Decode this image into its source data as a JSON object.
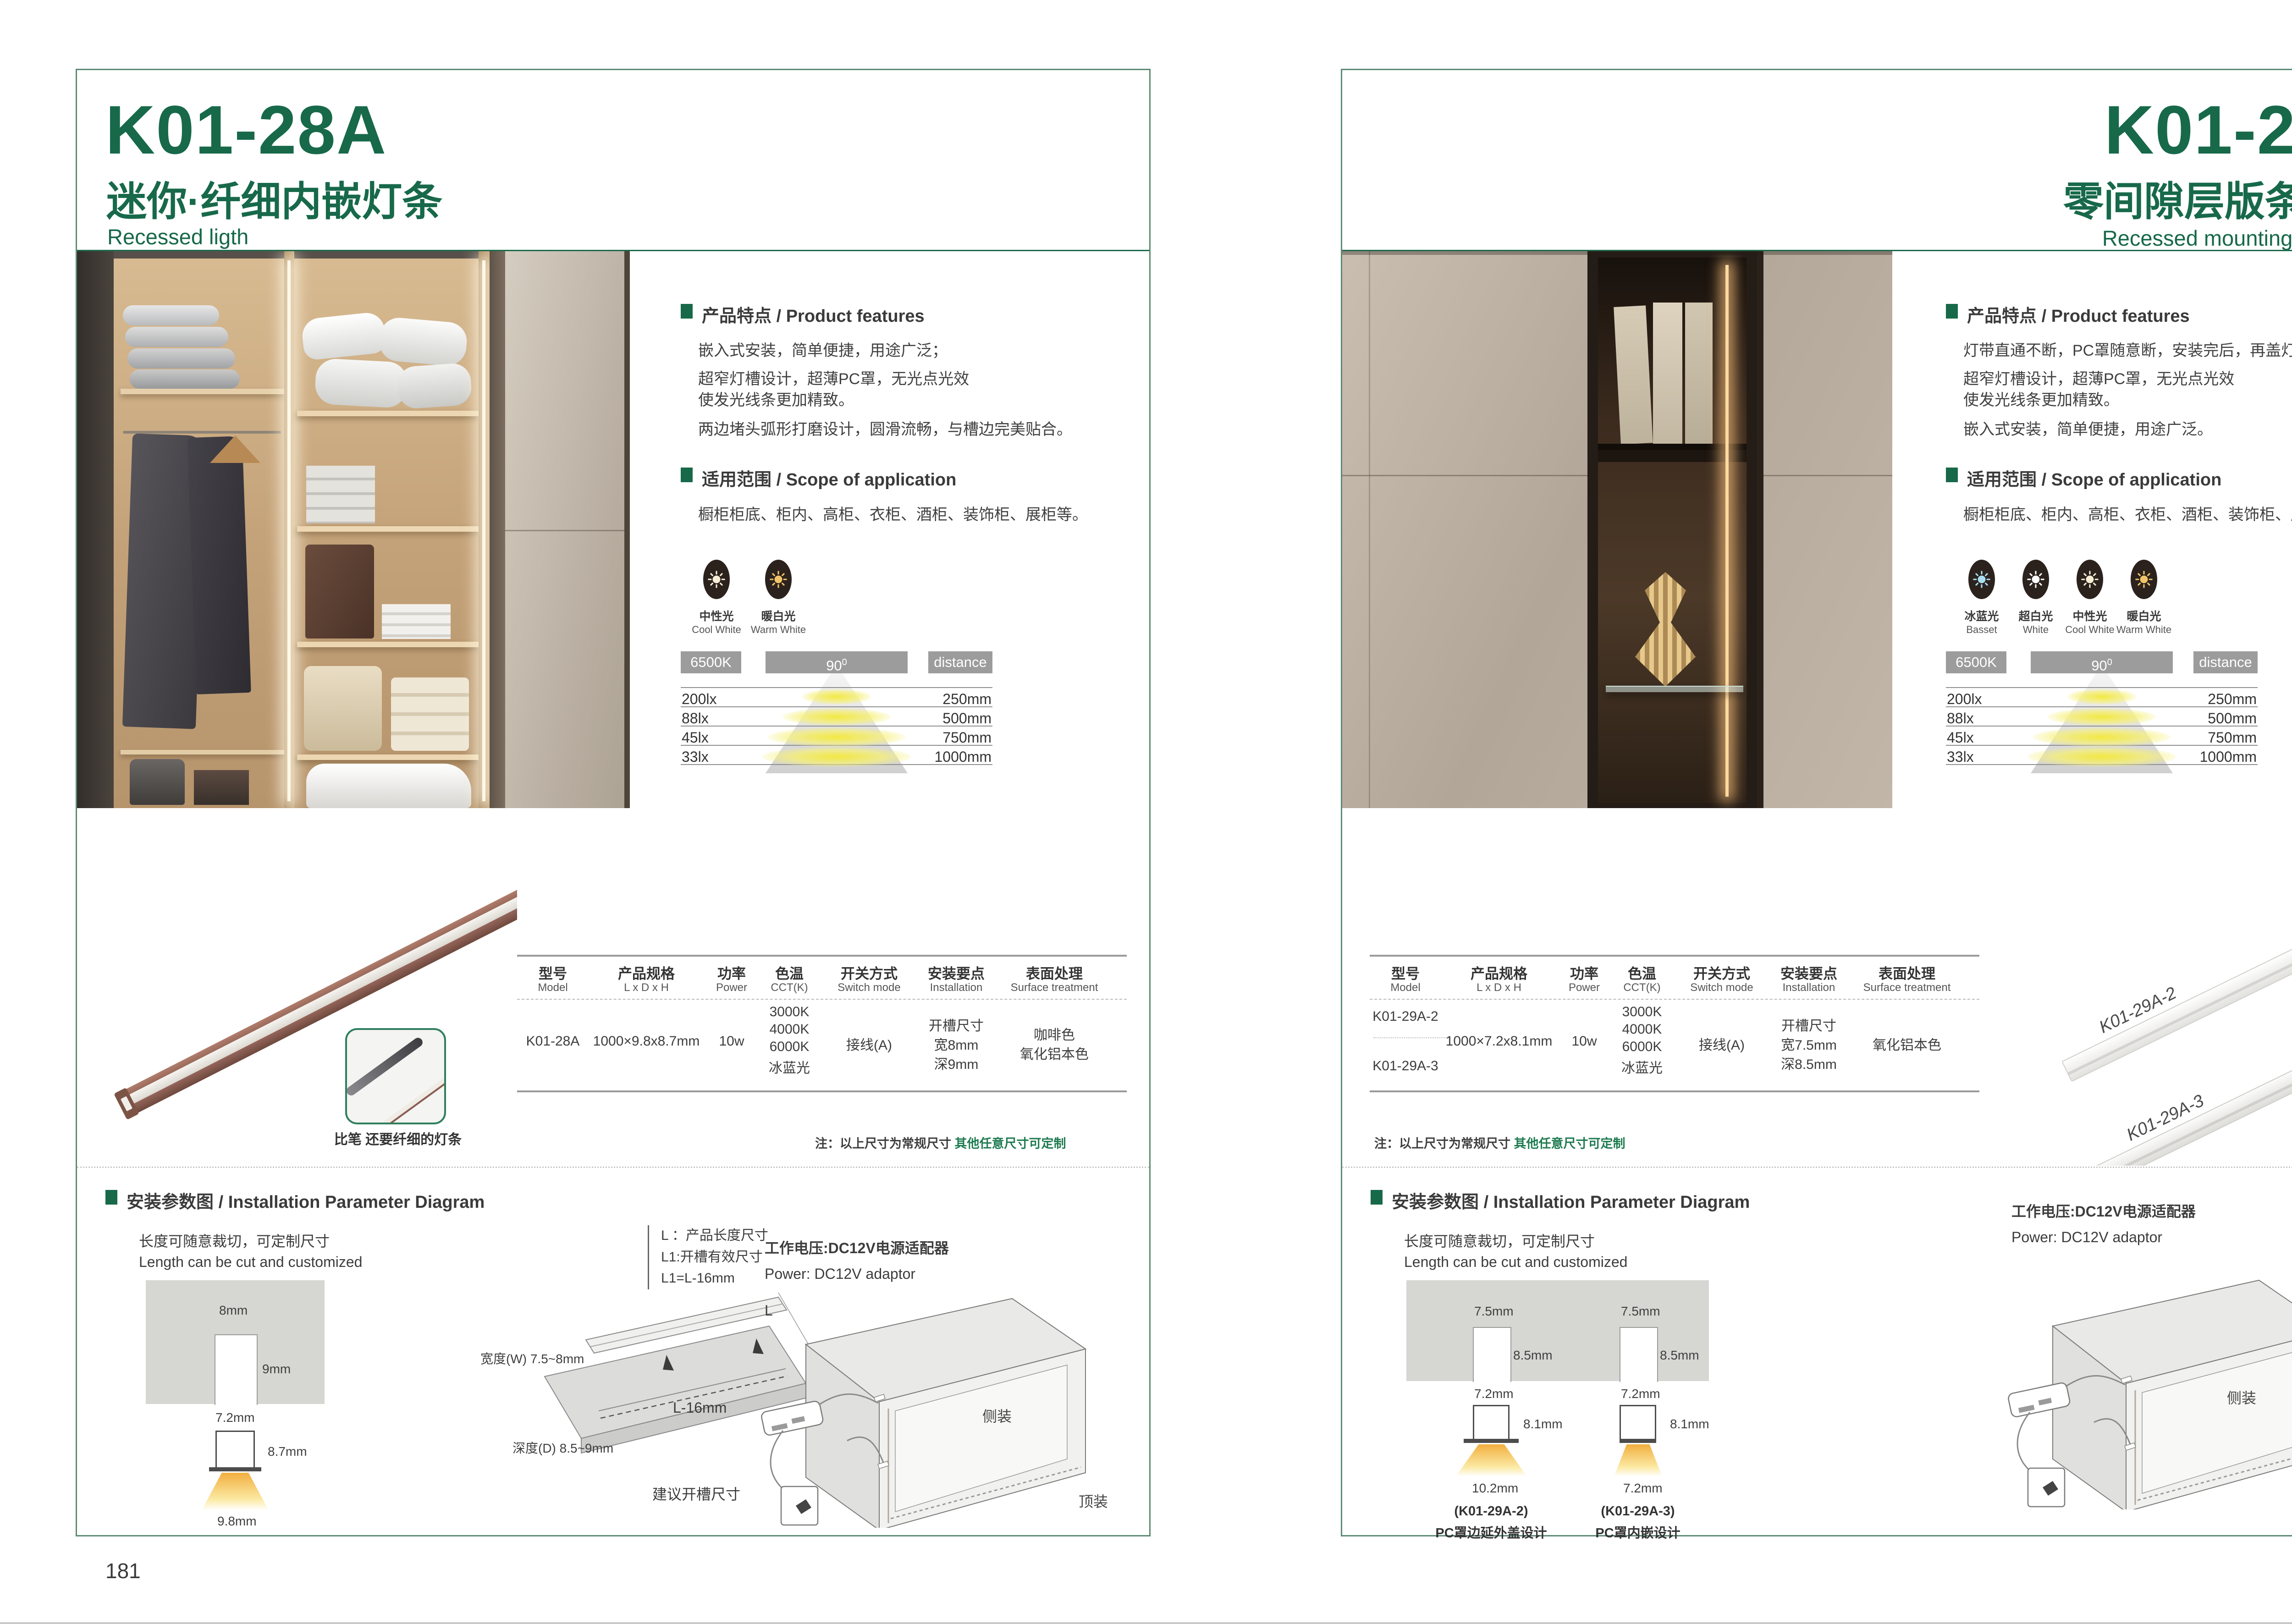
{
  "colors": {
    "green": "#17694a",
    "chip_gray": "#9c9c9c",
    "note_green": "#1d7a4f"
  },
  "left": {
    "page_number": "181",
    "model": "K01-28A",
    "subtitle_cn": "迷你·纤细内嵌灯条",
    "subtitle_en": "Recessed ligth",
    "features_title_cn": "产品特点",
    "features_title_en": "Product features",
    "features": [
      "嵌入式安装，简单便捷，用途广泛；",
      "超窄灯槽设计，超薄PC罩，无光点光效",
      "使发光线条更加精致。",
      "两边堵头弧形打磨设计，圆滑流畅，与槽边完美贴合。"
    ],
    "scope_title_cn": "适用范围",
    "scope_title_en": "Scope of application",
    "scope_text": "橱柜柜底、柜内、高柜、衣柜、酒柜、装饰柜、展柜等。",
    "light_options": [
      {
        "cn": "中性光",
        "en": "Cool White",
        "color": "#f8eed6"
      },
      {
        "cn": "暖白光",
        "en": "Warm White",
        "color": "#f2c468"
      }
    ],
    "photometry": {
      "cct": "6500K",
      "angle": "90",
      "angle_sup": "0",
      "distance_label": "distance",
      "rows": [
        {
          "lux": "200lx",
          "mm": "250mm"
        },
        {
          "lux": "88lx",
          "mm": "500mm"
        },
        {
          "lux": "45lx",
          "mm": "750mm"
        },
        {
          "lux": "33lx",
          "mm": "1000mm"
        }
      ]
    },
    "table": {
      "headers": [
        {
          "cn": "型号",
          "en": "Model"
        },
        {
          "cn": "产品规格",
          "en": "L x D x H"
        },
        {
          "cn": "功率",
          "en": "Power"
        },
        {
          "cn": "色温",
          "en": "CCT(K)"
        },
        {
          "cn": "开关方式",
          "en": "Switch mode"
        },
        {
          "cn": "安装要点",
          "en": "Installation"
        },
        {
          "cn": "表面处理",
          "en": "Surface treatment"
        }
      ],
      "model": "K01-28A",
      "spec": "1000×9.8x8.7mm",
      "power": "10w",
      "cct": [
        "3000K",
        "4000K",
        "6000K",
        "冰蓝光"
      ],
      "switch_mode": "接线(A)",
      "install": [
        "开槽尺寸",
        "宽8mm",
        "深9mm"
      ],
      "surface": [
        "咖啡色",
        "氧化铝本色"
      ]
    },
    "note_prefix": "注：以上尺寸为常规尺寸 ",
    "note_highlight": "其他任意尺寸可定制",
    "product_caption": "比笔 还要纤细的灯条",
    "install_sec": {
      "title_cn": "安装参数图",
      "title_en": "Installation Parameter Diagram",
      "length_cn": "长度可随意裁切，可定制尺寸",
      "length_en": "Length can be cut and customized",
      "slot_w": "8mm",
      "slot_d": "9mm",
      "slot_bottom": "7.2mm",
      "profile_h": "8.7mm",
      "light_w": "9.8mm",
      "legend": [
        "L ：产品长度尺寸",
        "L1:开槽有效尺寸",
        "L1=L-16mm"
      ],
      "board_w": "宽度(W) 7.5~8mm",
      "board_d": "深度(D) 8.5~9mm",
      "board_len": "L",
      "board_len2": "L-16mm",
      "board_caption": "建议开槽尺寸",
      "power_cn": "工作电压:DC12V电源适配器",
      "power_en": "Power: DC12V adaptor",
      "mount_side": "侧装",
      "mount_top": "顶装"
    }
  },
  "right": {
    "page_number": "182",
    "model": "K01-29A",
    "subtitle_cn": "零间隙层版条形灯",
    "subtitle_en": "Recessed mounting LED light",
    "features_title_cn": "产品特点",
    "features_title_en": "Product features",
    "features": [
      "灯带直通不断，PC罩随意断，安装完后，再盖灯罩；",
      "超窄灯槽设计，超薄PC罩，无光点光效",
      "使发光线条更加精致。",
      "嵌入式安装，简单便捷，用途广泛。"
    ],
    "scope_title_cn": "适用范围",
    "scope_title_en": "Scope of application",
    "scope_text": "橱柜柜底、柜内、高柜、衣柜、酒柜、装饰柜、展柜等。",
    "light_options": [
      {
        "cn": "冰蓝光",
        "en": "Basset",
        "color": "#a9def2"
      },
      {
        "cn": "超白光",
        "en": "White",
        "color": "#ffffff"
      },
      {
        "cn": "中性光",
        "en": "Cool White",
        "color": "#f8eed6"
      },
      {
        "cn": "暖白光",
        "en": "Warm White",
        "color": "#f2c468"
      }
    ],
    "photometry": {
      "cct": "6500K",
      "angle": "90",
      "angle_sup": "0",
      "distance_label": "distance",
      "rows": [
        {
          "lux": "200lx",
          "mm": "250mm"
        },
        {
          "lux": "88lx",
          "mm": "500mm"
        },
        {
          "lux": "45lx",
          "mm": "750mm"
        },
        {
          "lux": "33lx",
          "mm": "1000mm"
        }
      ]
    },
    "table": {
      "headers": [
        {
          "cn": "型号",
          "en": "Model"
        },
        {
          "cn": "产品规格",
          "en": "L x D x H"
        },
        {
          "cn": "功率",
          "en": "Power"
        },
        {
          "cn": "色温",
          "en": "CCT(K)"
        },
        {
          "cn": "开关方式",
          "en": "Switch mode"
        },
        {
          "cn": "安装要点",
          "en": "Installation"
        },
        {
          "cn": "表面处理",
          "en": "Surface treatment"
        }
      ],
      "models": [
        "K01-29A-2",
        "K01-29A-3"
      ],
      "spec": "1000×7.2x8.1mm",
      "power": "10w",
      "cct": [
        "3000K",
        "4000K",
        "6000K",
        "冰蓝光"
      ],
      "switch_mode": "接线(A)",
      "install": [
        "开槽尺寸",
        "宽7.5mm",
        "深8.5mm"
      ],
      "surface": [
        "氧化铝本色"
      ]
    },
    "note_prefix": "注：以上尺寸为常规尺寸 ",
    "note_highlight": "其他任意尺寸可定制",
    "product_labels": [
      "K01-29A-2",
      "K01-29A-3"
    ],
    "install_sec": {
      "title_cn": "安装参数图",
      "title_en": "Installation Parameter Diagram",
      "length_cn": "长度可随意裁切，可定制尺寸",
      "length_en": "Length can be cut and customized",
      "sections": [
        {
          "model": "(K01-29A-2)",
          "desc": "PC罩边延外盖设计",
          "slot_w": "7.5mm",
          "slot_d": "8.5mm",
          "slot_bottom": "7.2mm",
          "profile_h": "8.1mm",
          "light_w": "10.2mm"
        },
        {
          "model": "(K01-29A-3)",
          "desc": "PC罩内嵌设计",
          "slot_w": "7.5mm",
          "slot_d": "8.5mm",
          "slot_bottom": "7.2mm",
          "profile_h": "8.1mm",
          "light_w": "7.2mm"
        }
      ],
      "power_cn": "工作电压:DC12V电源适配器",
      "power_en": "Power: DC12V adaptor",
      "mount_side": "侧装",
      "mount_top": "顶装"
    }
  }
}
